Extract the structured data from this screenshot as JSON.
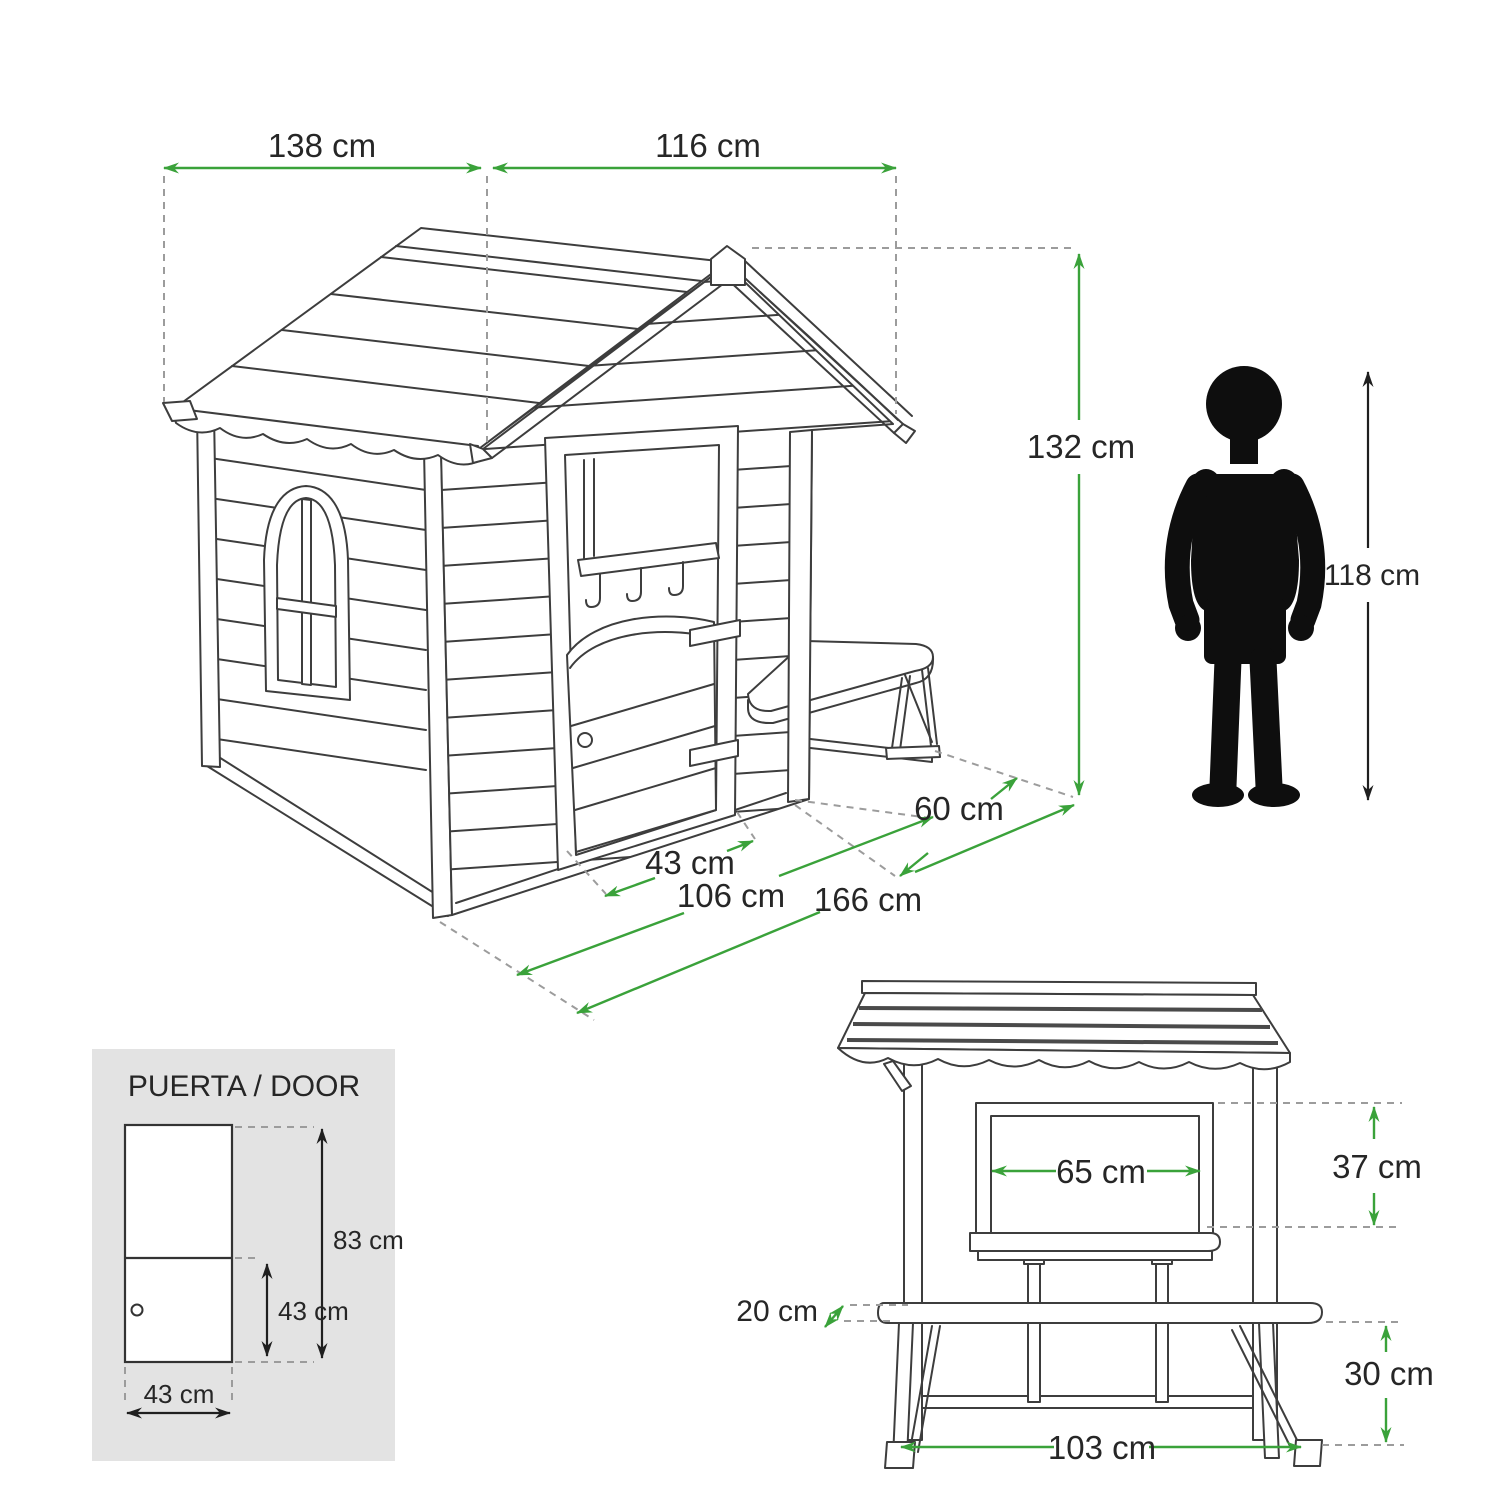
{
  "diagram_type": "playhouse dimensional drawing",
  "colors": {
    "dimension_green": "#3AA23A",
    "line_art": "#3d3d3d",
    "dashed_gray": "#9c9c9c",
    "panel_gray": "#e3e3e3",
    "silhouette_black": "#0e0e0e",
    "text_dark": "#262626",
    "background": "#ffffff"
  },
  "iso": {
    "dim_depth": "138 cm",
    "dim_width": "116 cm",
    "dim_height": "132 cm",
    "dim_door": "43 cm",
    "dim_front": "106 cm",
    "dim_total": "166 cm",
    "dim_bench": "60 cm",
    "dim_child": "118 cm"
  },
  "door_panel": {
    "title": "PUERTA / DOOR",
    "dim_height_total": "83 cm",
    "dim_height_lower": "43 cm",
    "dim_width": "43 cm"
  },
  "front_view": {
    "dim_window_width": "65 cm",
    "dim_window_height": "37 cm",
    "dim_bench_depth": "20 cm",
    "dim_bench_height": "30 cm",
    "dim_length": "103 cm"
  }
}
